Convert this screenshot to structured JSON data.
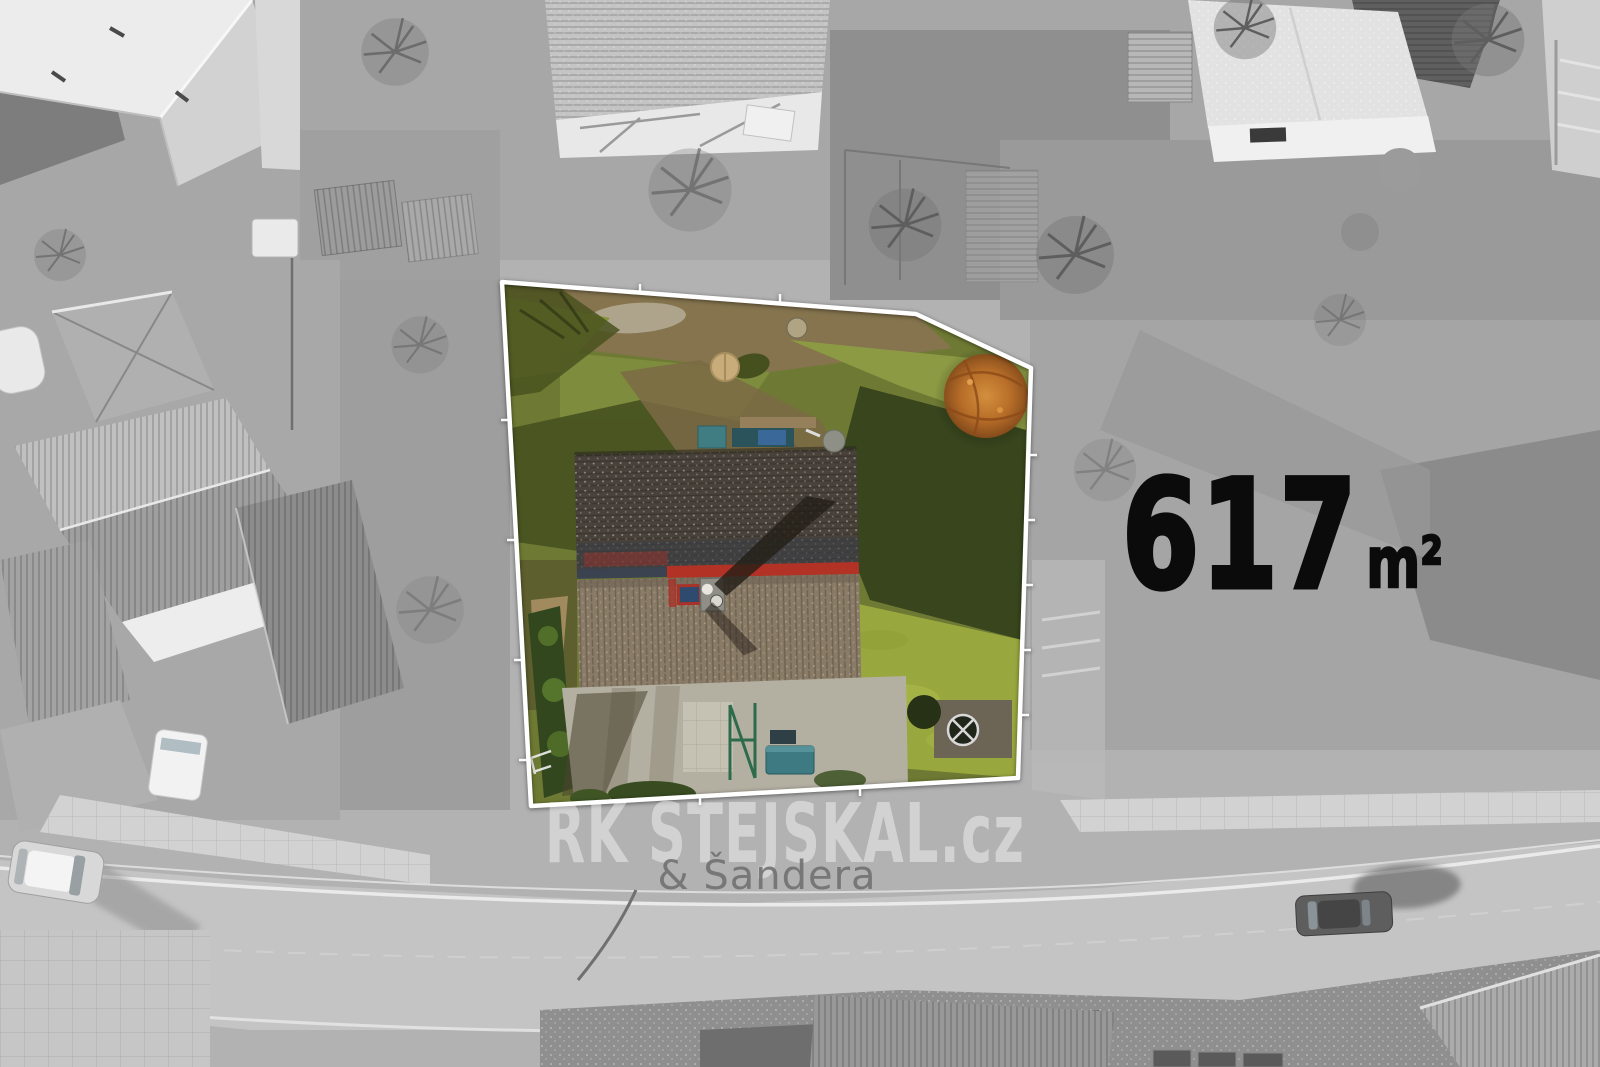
{
  "scene": {
    "description": "Black-and-white aerial drone photo of a neighborhood with one property plot highlighted in color and outlined in white",
    "area_label": {
      "value": "617",
      "unit": "m²"
    },
    "watermark": {
      "title": "RK STEJSKAL.cz",
      "subtitle": "& Šandera"
    },
    "plot": {
      "boundary_points": "502,282 916,314 1031,368 1018,778 531,806",
      "outline_color": "#ffffff"
    },
    "colors": {
      "area_text": "#0b0b0b",
      "background_gray": "#b2b2b2",
      "road_gray": "#c4c4c4",
      "grass_base": "#6e7a33",
      "grass_sunlit": "#99a83e",
      "grass_shadow": "#38451d",
      "roof_upper": "#49423a",
      "roof_lower": "#8a7b66",
      "ridge_red": "#b23226",
      "autumn_tree_orange": "#bc6e28",
      "pool_tan": "#c8ac79",
      "shed_teal": "#3d7a81"
    }
  }
}
